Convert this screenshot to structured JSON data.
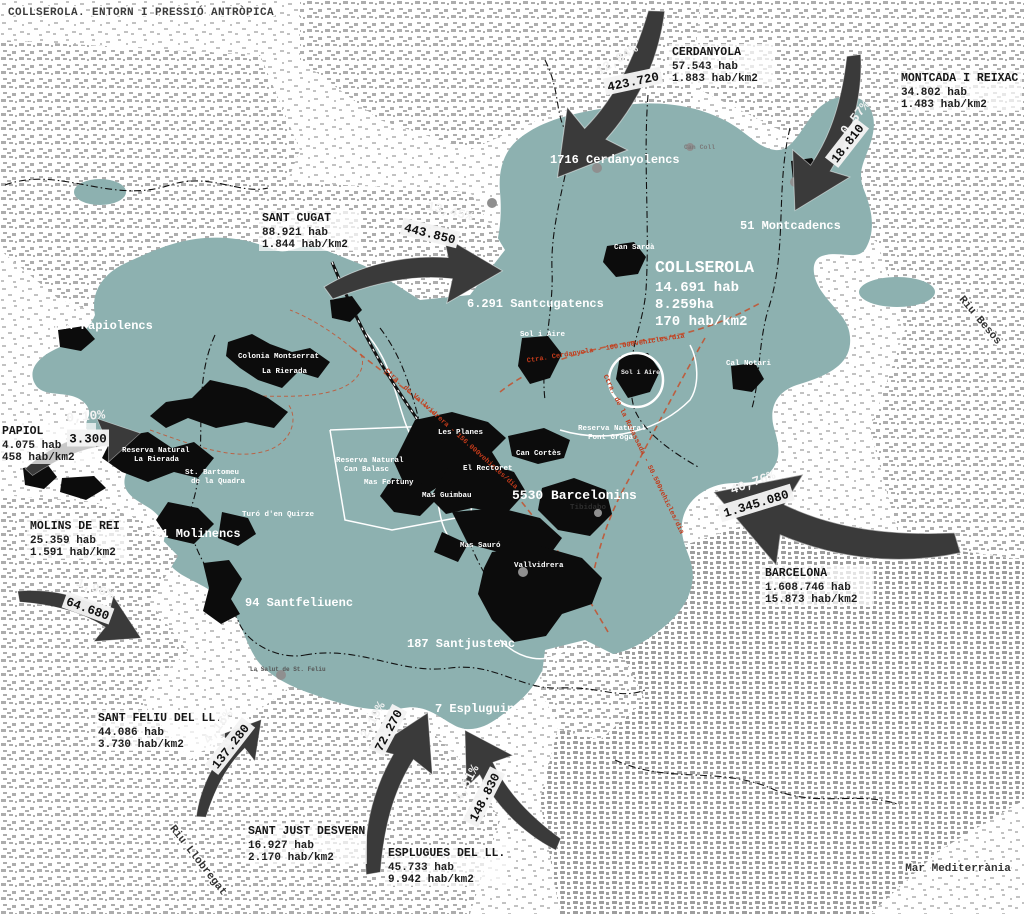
{
  "title": "COLLSEROLA. ENTORN I PRESSIÓ ANTRÒPICA",
  "colors": {
    "park_teal": "#8db1b0",
    "arrow_gray": "#3a3a3a",
    "road_orange": "#c4502c",
    "road_label_red": "#c23a1a"
  },
  "park": {
    "name": "COLLSEROLA",
    "hab": "14.691 hab",
    "area": "8.259ha",
    "density": "170 hab/km2"
  },
  "districts": [
    {
      "text": "1716 Cerdanyolencs"
    },
    {
      "text": "51 Montcadencs"
    },
    {
      "text": "6.291 Santcugatencs"
    },
    {
      "text": "114 Papiolencs"
    },
    {
      "text": "701 Molinencs"
    },
    {
      "text": "94 Santfeliuenc"
    },
    {
      "text": "187 Santjustenc"
    },
    {
      "text": "7 Espluguins"
    },
    {
      "text": "5530 Barcelonins"
    }
  ],
  "municipalities": [
    {
      "name": "CERDANYOLA",
      "hab": "57.543 hab",
      "density": "1.883 hab/km2",
      "pct": "12,84%",
      "flow": "423.720"
    },
    {
      "name": "MONTCADA I REIXAC",
      "hab": "34.802 hab",
      "density": "1.483 hab/km2",
      "pct": "0,57%",
      "flow": "18.810"
    },
    {
      "name": "SANT CUGAT",
      "hab": "88.921 hab",
      "density": "1.844 hab/km2",
      "pct": "13,45%",
      "flow": "443.850"
    },
    {
      "name": "PAPIOL",
      "hab": "4.075 hab",
      "density": "458 hab/km2",
      "pct": "0,10%",
      "flow": "3.300"
    },
    {
      "name": "MOLINS DE REI",
      "hab": "25.359 hab",
      "density": "1.591 hab/km2",
      "pct": "1,96%",
      "flow": "64.680"
    },
    {
      "name": "SANT FELIU DEL LL.",
      "hab": "44.086 hab",
      "density": "3.730 hab/km2",
      "pct": "4,16%",
      "flow": "137.280"
    },
    {
      "name": "SANT JUST DESVERN",
      "hab": "16.927 hab",
      "density": "2.170 hab/km2",
      "pct": "2,19%",
      "flow": "72.270"
    },
    {
      "name": "ESPLUGUES DEL LL.",
      "hab": "45.733 hab",
      "density": "9.942 hab/km2",
      "pct": "4,51%",
      "flow": "148.830"
    },
    {
      "name": "BARCELONA",
      "hab": "1.608.746 hab",
      "density": "15.873 hab/km2",
      "pct": "40,76%",
      "flow": "1.345.080"
    }
  ],
  "places": {
    "les_planes": "Les Planes",
    "el_rectoret": "El Rectoret",
    "can_cortes": "Can Cortès",
    "mas_guimbau": "Mas Guimbau",
    "mas_sauro": "Mas Sauró",
    "vallvidrera": "Vallvidrera",
    "tibidabo": "Tibidabo",
    "colonia_montserrat": "Colonia Montserrat",
    "la_rierada": "La Rierada",
    "st_bartomeu_1": "St. Bartomeu",
    "st_bartomeu_2": "de la Quadra",
    "turo_den_quirze": "Turó d'en Quirze",
    "mas_fortuny": "Mas Fortuny",
    "can_sarda": "Can Sardà",
    "sol_i_aire": "Sol i Aire",
    "cal_notari": "Cal Notari",
    "can_coll": "Can Coll",
    "la_salut": "La Salut de St. Feliu"
  },
  "reserves": {
    "la_rierada": [
      "Reserva Natural",
      "La Rierada"
    ],
    "can_balasc": [
      "Reserva Natural",
      "Can Balasc"
    ],
    "font_groga": [
      "Reserva Natural",
      "Font Groga"
    ]
  },
  "roads": [
    "Ctra. de Vallvidrera - 156.000vehicles/dia",
    "Ctra. de la Rabassada - 50.500vehicles/dia",
    "Ctra. Cerdanyola - 100.000vehicles/dia"
  ],
  "geo": {
    "riu_llobregat": "Riu Llobregat",
    "riu_besos": "Riu Besòs",
    "mar": "Mar Mediterrània"
  }
}
